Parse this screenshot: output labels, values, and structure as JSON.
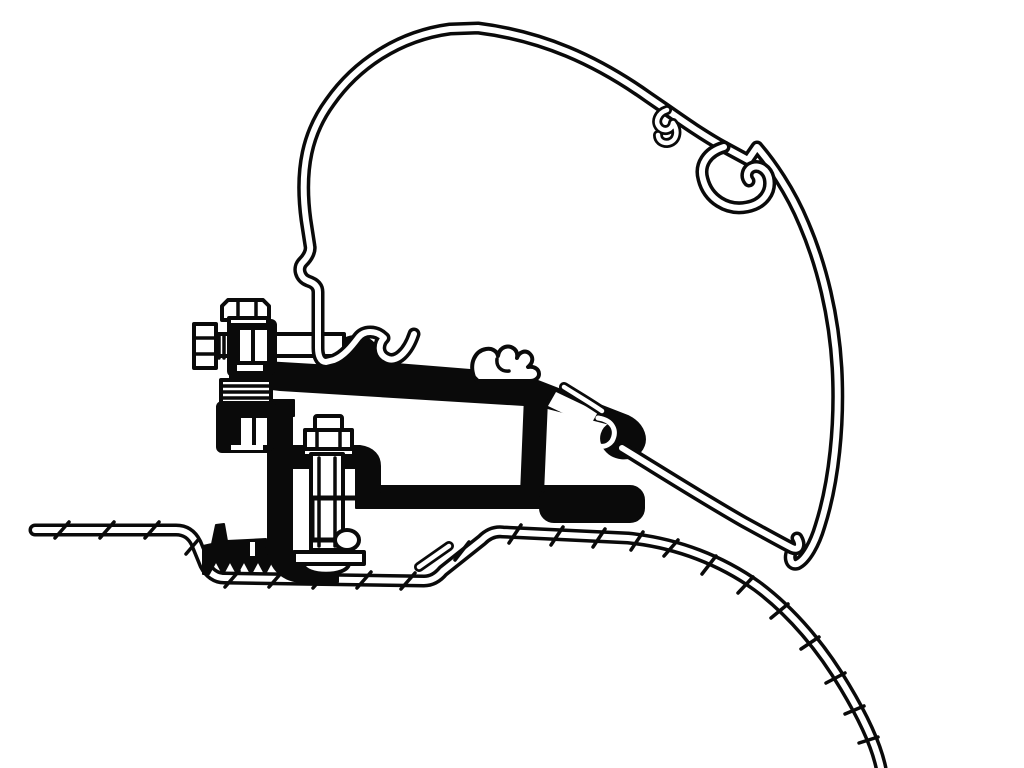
{
  "canvas": {
    "width": 1024,
    "height": 768,
    "background_color": "#ffffff",
    "line_color": "#0a0a0a"
  },
  "colors": {
    "bg": "#ffffff",
    "ink": "#0a0a0a"
  },
  "diagram": {
    "kind": "technical-cross-section-line-drawing",
    "text_labels": [],
    "parts": [
      {
        "id": "awning-profile-shell",
        "style": "double-line sheet profile"
      },
      {
        "id": "awning-profile-small-hook",
        "style": "double-line hook"
      },
      {
        "id": "awning-profile-c-channel",
        "style": "double-line open C channel"
      },
      {
        "id": "awning-profile-lower-skin",
        "style": "double-line leg"
      },
      {
        "id": "adapter-rail",
        "style": "solid black extrusion"
      },
      {
        "id": "adapter-rail-crown-clip",
        "style": "outlined clip on rail top"
      },
      {
        "id": "adapter-rail-end-hook",
        "style": "solid hook with inner channel"
      },
      {
        "id": "support-strut",
        "style": "solid black"
      },
      {
        "id": "base-rail",
        "style": "solid black with rounded end"
      },
      {
        "id": "clamp-channel",
        "style": "solid black C channel"
      },
      {
        "id": "horizontal-bolt",
        "style": "outlined bolt with serrated washers"
      },
      {
        "id": "top-bolt-head",
        "style": "outlined hex head"
      },
      {
        "id": "upper-clamp-block",
        "style": "solid black with windows"
      },
      {
        "id": "washer-stack",
        "style": "outlined striped stack"
      },
      {
        "id": "lower-clamp-block",
        "style": "solid black with windows"
      },
      {
        "id": "vertical-bolt",
        "style": "outlined threaded bolt with nut"
      },
      {
        "id": "inner-c-bracket",
        "style": "outlined C bracket"
      },
      {
        "id": "foot-plate",
        "style": "outlined plate with dome"
      },
      {
        "id": "rubber-pad",
        "style": "solid black serrated pad"
      },
      {
        "id": "van-roof-sheet",
        "style": "double-line with hatch ticks"
      }
    ]
  }
}
